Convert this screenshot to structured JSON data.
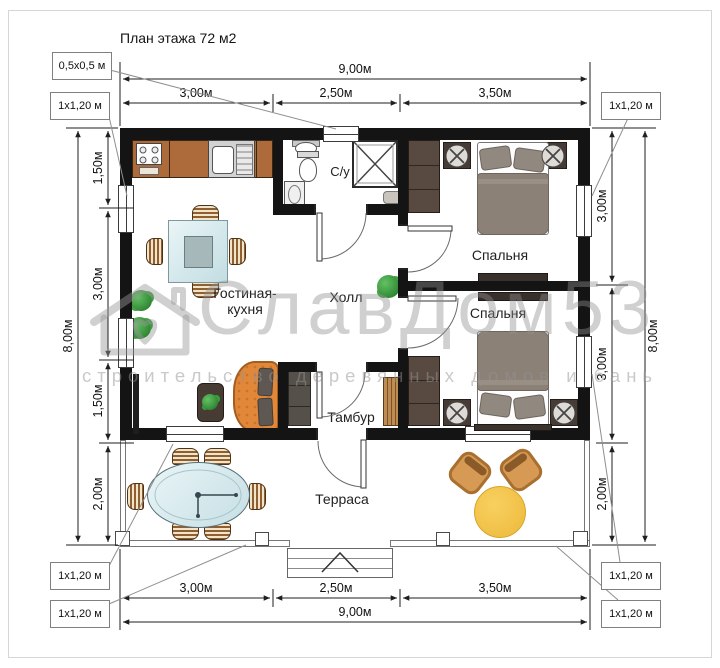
{
  "title": "План этажа 72 м2",
  "watermark": {
    "brand": "СлавДом53",
    "tagline": "строительство деревянных домов и бань"
  },
  "rooms": {
    "living_kitchen": [
      "Гостиная-",
      "кухня"
    ],
    "hall": "Холл",
    "bathroom": "С/у",
    "bedroom_top": "Спальня",
    "bedroom_bottom": "Спальня",
    "tambour": "Тамбур",
    "terrace": "Терраса"
  },
  "dimensions": {
    "top": {
      "overall": "9,00м",
      "segments": [
        "3,00м",
        "2,50м",
        "3,50м"
      ]
    },
    "bottom": {
      "overall": "9,00м",
      "segments": [
        "3,00м",
        "2,50м",
        "3,50м"
      ]
    },
    "left": {
      "overall": "8,00м",
      "segments": [
        "1,50м",
        "3,00м",
        "1,50м",
        "2,00м"
      ]
    },
    "right": {
      "overall": "8,00м",
      "segments": [
        "3,00м",
        "3,00м",
        "2,00м"
      ]
    }
  },
  "callouts": {
    "top_small": "0,5х0,5 м",
    "left_upper": "1х1,20 м",
    "right_upper": "1х1,20 м",
    "bottom_left_1": "1х1,20 м",
    "bottom_left_2": "1х1,20 м",
    "bottom_right_1": "1х1,20 м",
    "bottom_right_2": "1х1,20 м"
  },
  "colors": {
    "wall": "#141414",
    "kitchen_counter": "#ad6a3b",
    "sofa": "#e0873a",
    "bed_blanket": "#8b8177",
    "glass": "#d5e9ec",
    "plant": "#3a9e3c",
    "terrace_table": "#f3c44d",
    "wicker": "#d79a55",
    "watermark": "#9a9a9a"
  }
}
